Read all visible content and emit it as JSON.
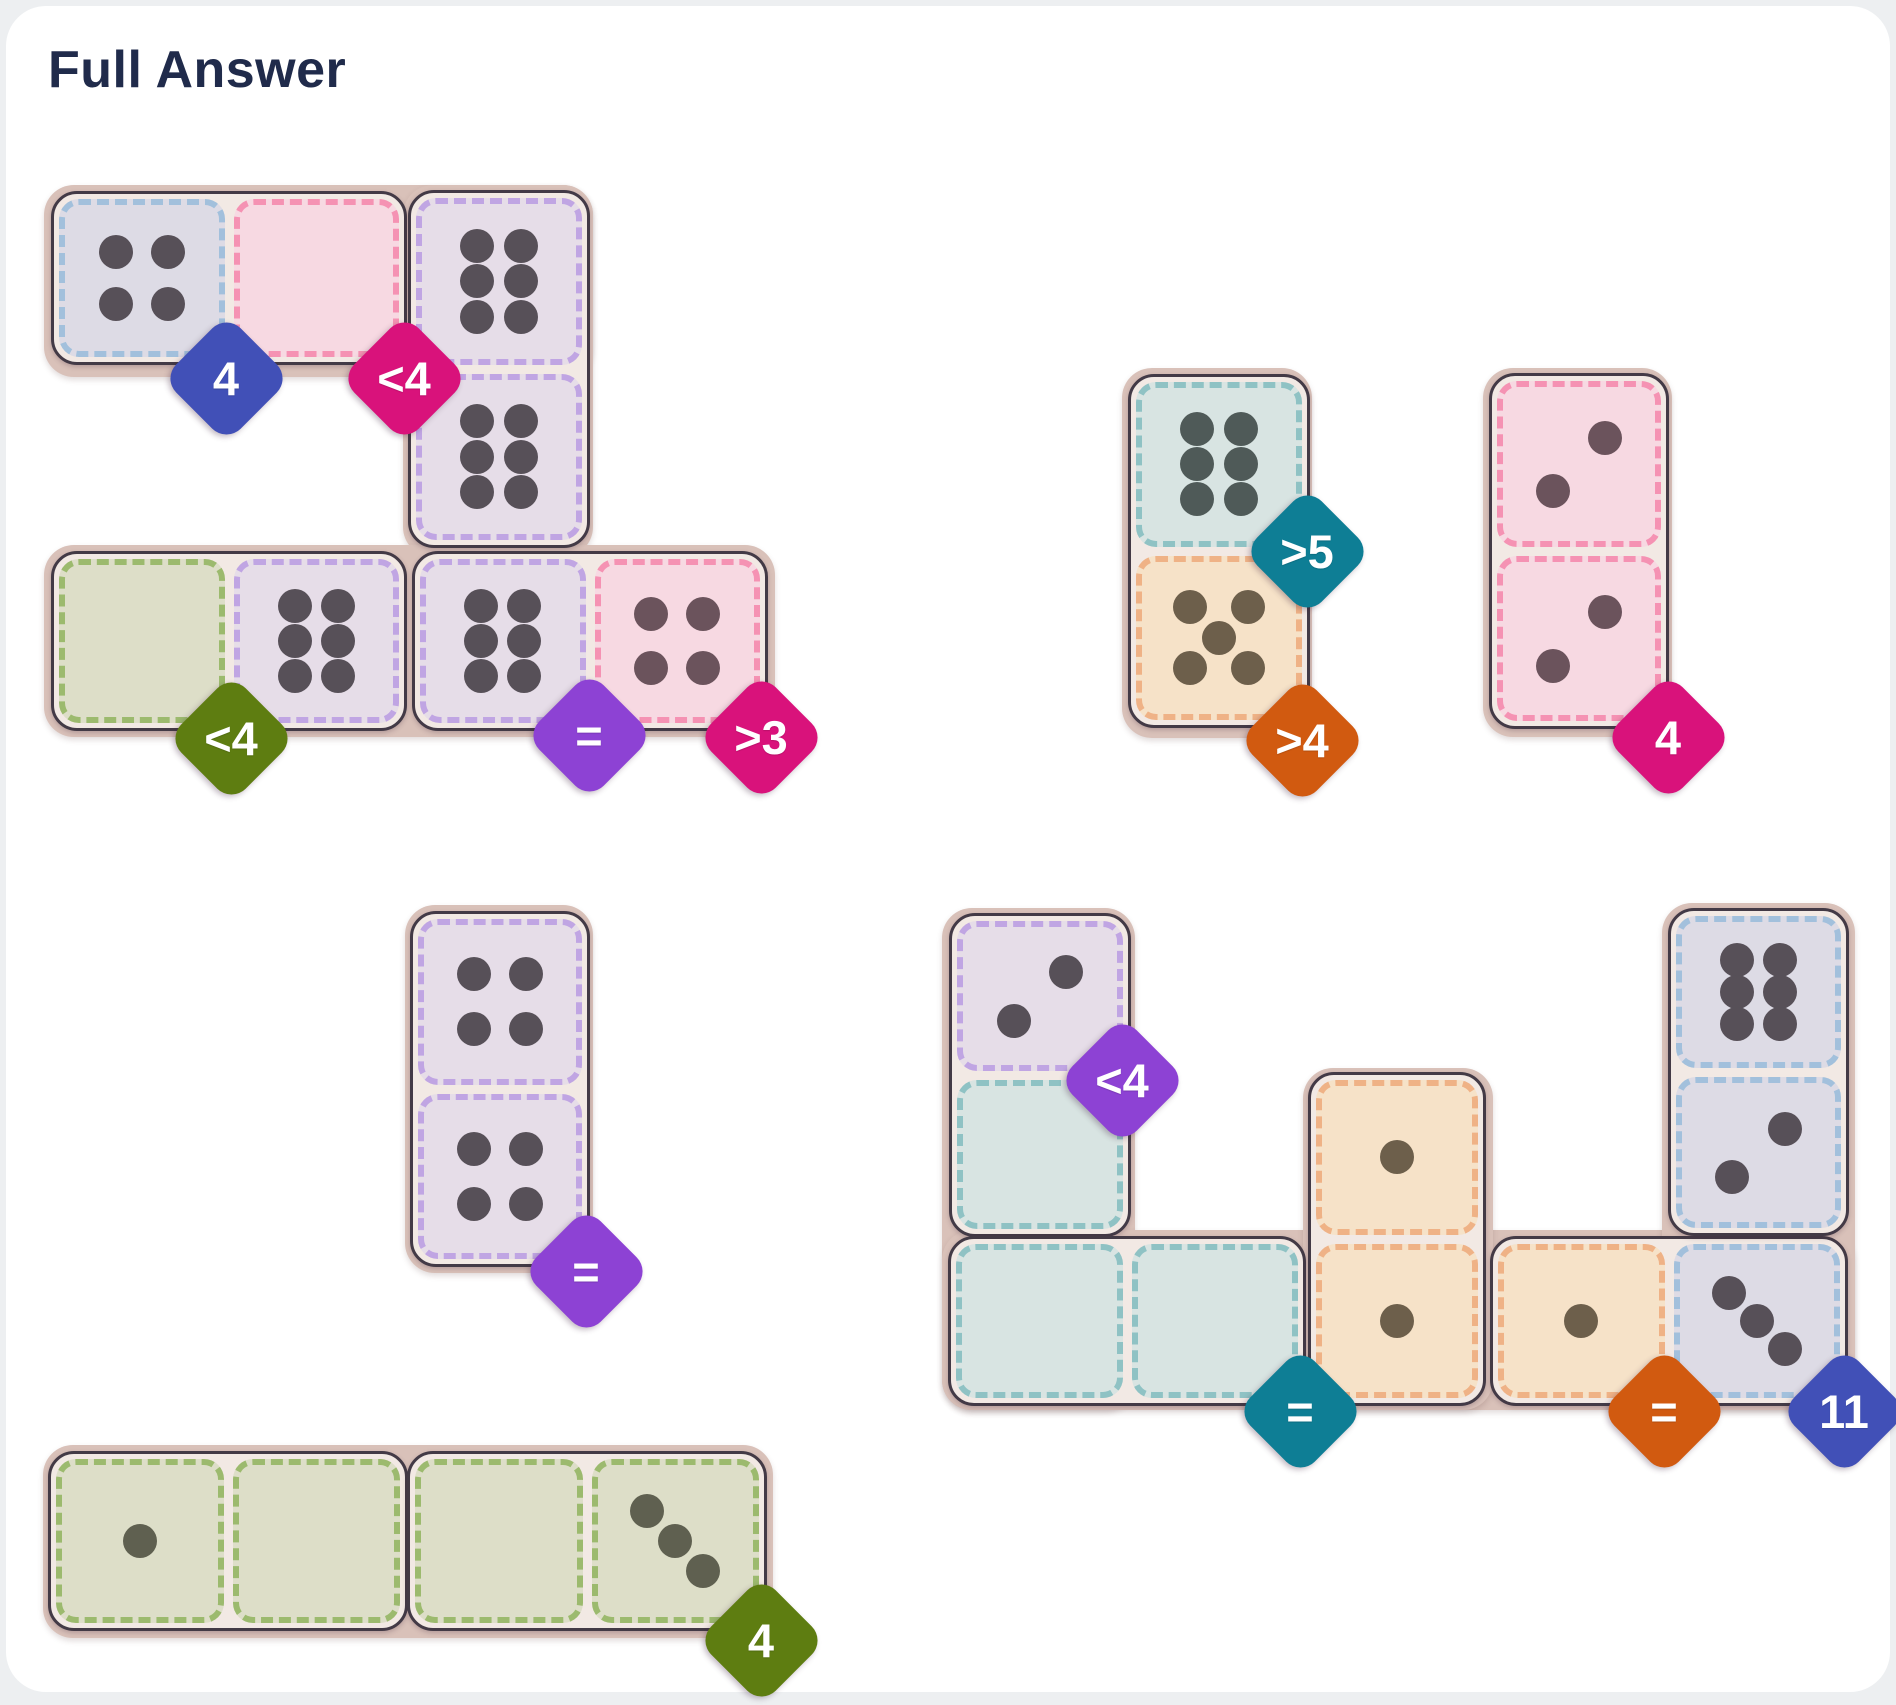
{
  "page": {
    "title": "Full Answer"
  },
  "board": {
    "tray_color": "#d9c1b9",
    "domino_outline": "#433a46",
    "domino_gap_color": "#f2e9e4",
    "regions": {
      "lavender": {
        "fill": "#e6dde8",
        "dash": "#c0a5e3",
        "dot": "#575058"
      },
      "bluegray": {
        "fill": "#dddbe5",
        "dash": "#a2c0dc",
        "dot": "#575058"
      },
      "pink": {
        "fill": "#f7d9e2",
        "dash": "#f592b3",
        "dot": "#6b535c"
      },
      "green": {
        "fill": "#dddec8",
        "dash": "#9cba6e",
        "dot": "#5f6050"
      },
      "teal": {
        "fill": "#d8e4e2",
        "dash": "#8fc2c4",
        "dot": "#4f5a58"
      },
      "tan": {
        "fill": "#f6e2c8",
        "dash": "#efb286",
        "dot": "#6d5f4b"
      }
    },
    "badge_colors": {
      "blue": "#4150b7",
      "magenta": "#d9127b",
      "olive": "#5e7d11",
      "purple": "#8d42d4",
      "teal": "#0e7e95",
      "orange": "#d15a10"
    },
    "groups": [
      {
        "id": "top-left",
        "trays": [
          {
            "x": 44,
            "y": 185,
            "w": 549,
            "h": 192
          },
          {
            "x": 403,
            "y": 185,
            "w": 190,
            "h": 372
          },
          {
            "x": 44,
            "y": 545,
            "w": 731,
            "h": 192
          }
        ],
        "dominoes": [
          {
            "orient": "h",
            "x": 51,
            "y": 191,
            "w": 356,
            "h": 174,
            "cells": [
              {
                "region": "bluegray",
                "pips": 4
              },
              {
                "region": "pink",
                "pips": 0
              }
            ]
          },
          {
            "orient": "v",
            "x": 408,
            "y": 190,
            "w": 182,
            "h": 358,
            "cells": [
              {
                "region": "lavender",
                "pips": 6
              },
              {
                "region": "lavender",
                "pips": 6
              }
            ]
          },
          {
            "orient": "h",
            "x": 51,
            "y": 551,
            "w": 356,
            "h": 180,
            "cells": [
              {
                "region": "green",
                "pips": 0
              },
              {
                "region": "lavender",
                "pips": 6
              }
            ]
          },
          {
            "orient": "h",
            "x": 412,
            "y": 551,
            "w": 356,
            "h": 180,
            "cells": [
              {
                "region": "lavender",
                "pips": 6
              },
              {
                "region": "pink",
                "pips": 4
              }
            ]
          }
        ],
        "badges": [
          {
            "label": "4",
            "color": "blue",
            "x": 226,
            "y": 378
          },
          {
            "label": "<4",
            "color": "magenta",
            "x": 404,
            "y": 378
          },
          {
            "label": "<4",
            "color": "olive",
            "x": 231,
            "y": 738
          },
          {
            "label": "=",
            "color": "purple",
            "x": 589,
            "y": 735
          },
          {
            "label": ">3",
            "color": "magenta",
            "x": 761,
            "y": 737
          }
        ]
      },
      {
        "id": "top-right",
        "trays": [
          {
            "x": 1122,
            "y": 368,
            "w": 190,
            "h": 370
          },
          {
            "x": 1483,
            "y": 368,
            "w": 189,
            "h": 369
          }
        ],
        "dominoes": [
          {
            "orient": "v",
            "x": 1128,
            "y": 374,
            "w": 182,
            "h": 354,
            "cells": [
              {
                "region": "teal",
                "pips": 6
              },
              {
                "region": "tan",
                "pips": 5
              }
            ]
          },
          {
            "orient": "v",
            "x": 1489,
            "y": 373,
            "w": 180,
            "h": 356,
            "cells": [
              {
                "region": "pink",
                "pips": 2
              },
              {
                "region": "pink",
                "pips": 2
              }
            ]
          }
        ],
        "badges": [
          {
            "label": ">5",
            "color": "teal",
            "x": 1307,
            "y": 551
          },
          {
            "label": ">4",
            "color": "orange",
            "x": 1302,
            "y": 740
          },
          {
            "label": "4",
            "color": "magenta",
            "x": 1668,
            "y": 737
          }
        ]
      },
      {
        "id": "middle-left",
        "trays": [
          {
            "x": 405,
            "y": 905,
            "w": 188,
            "h": 368
          }
        ],
        "dominoes": [
          {
            "orient": "v",
            "x": 410,
            "y": 911,
            "w": 180,
            "h": 356,
            "cells": [
              {
                "region": "lavender",
                "pips": 4
              },
              {
                "region": "lavender",
                "pips": 4
              }
            ]
          }
        ],
        "badges": [
          {
            "label": "=",
            "color": "purple",
            "x": 586,
            "y": 1271
          }
        ]
      },
      {
        "id": "bottom-left",
        "trays": [
          {
            "x": 43,
            "y": 1445,
            "w": 730,
            "h": 193
          }
        ],
        "dominoes": [
          {
            "orient": "h",
            "x": 48,
            "y": 1451,
            "w": 360,
            "h": 180,
            "cells": [
              {
                "region": "green",
                "pips": 1
              },
              {
                "region": "green",
                "pips": 0
              }
            ]
          },
          {
            "orient": "h",
            "x": 407,
            "y": 1451,
            "w": 360,
            "h": 180,
            "cells": [
              {
                "region": "green",
                "pips": 0
              },
              {
                "region": "green",
                "pips": 3
              }
            ]
          }
        ],
        "badges": [
          {
            "label": "4",
            "color": "olive",
            "x": 761,
            "y": 1640
          }
        ]
      },
      {
        "id": "bottom-right",
        "trays": [
          {
            "x": 942,
            "y": 908,
            "w": 193,
            "h": 502
          },
          {
            "x": 942,
            "y": 1230,
            "w": 913,
            "h": 180
          },
          {
            "x": 1303,
            "y": 1068,
            "w": 190,
            "h": 342
          },
          {
            "x": 1662,
            "y": 903,
            "w": 193,
            "h": 507
          }
        ],
        "dominoes": [
          {
            "orient": "v",
            "x": 949,
            "y": 913,
            "w": 182,
            "h": 324,
            "cells": [
              {
                "region": "lavender",
                "pips": 2
              },
              {
                "region": "teal",
                "pips": 0
              }
            ]
          },
          {
            "orient": "h",
            "x": 948,
            "y": 1236,
            "w": 358,
            "h": 170,
            "cells": [
              {
                "region": "teal",
                "pips": 0
              },
              {
                "region": "teal",
                "pips": 0
              }
            ]
          },
          {
            "orient": "v",
            "x": 1308,
            "y": 1072,
            "w": 178,
            "h": 334,
            "cells": [
              {
                "region": "tan",
                "pips": 1
              },
              {
                "region": "tan",
                "pips": 1
              }
            ]
          },
          {
            "orient": "h",
            "x": 1490,
            "y": 1236,
            "w": 358,
            "h": 170,
            "cells": [
              {
                "region": "tan",
                "pips": 1
              },
              {
                "region": "bluegray",
                "pips": 3
              }
            ]
          },
          {
            "orient": "v",
            "x": 1668,
            "y": 908,
            "w": 181,
            "h": 328,
            "cells": [
              {
                "region": "bluegray",
                "pips": 6
              },
              {
                "region": "bluegray",
                "pips": 2
              }
            ]
          }
        ],
        "badges": [
          {
            "label": "<4",
            "color": "purple",
            "x": 1122,
            "y": 1080
          },
          {
            "label": "=",
            "color": "teal",
            "x": 1300,
            "y": 1411
          },
          {
            "label": "=",
            "color": "orange",
            "x": 1664,
            "y": 1411
          },
          {
            "label": "11",
            "color": "blue",
            "x": 1844,
            "y": 1411
          }
        ]
      }
    ]
  }
}
